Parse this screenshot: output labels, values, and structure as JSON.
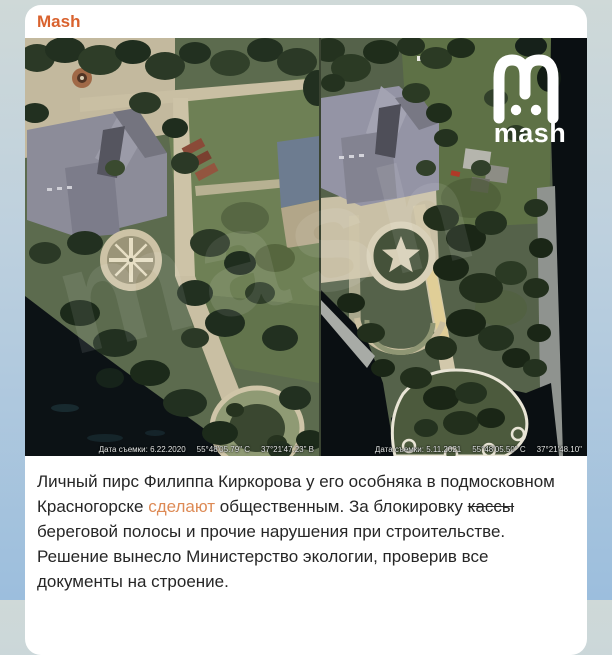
{
  "header": {
    "channel_name": "Mash"
  },
  "photos": {
    "watermark_text": "mash",
    "logo_text": "mash",
    "before": {
      "capture_date": "Дата съемки: 6.22.2020",
      "latitude": "55°48'05.79\" С",
      "longitude": "37°21'47.23\" В"
    },
    "after": {
      "capture_date": "Дата съемки: 5.11.2021",
      "latitude": "55°48'05.50\" С",
      "longitude": "37°21'48.10\""
    }
  },
  "post": {
    "part1": "Личный пирс Филиппа Киркорова у его особняка в подмосковном Красногорске ",
    "link_text": "сделают",
    "part2": " общественным. За блокировку ",
    "struck_text": "кассы",
    "part3": " береговой полосы и прочие нарушения при строительстве. Решение вынесло Министерство экологии, проверив все документы на строение."
  },
  "colors": {
    "channel_accent": "#d9622e",
    "link": "#dd8a55",
    "background_top": "#cfd9d8",
    "background_bottom": "#9cbedd"
  }
}
